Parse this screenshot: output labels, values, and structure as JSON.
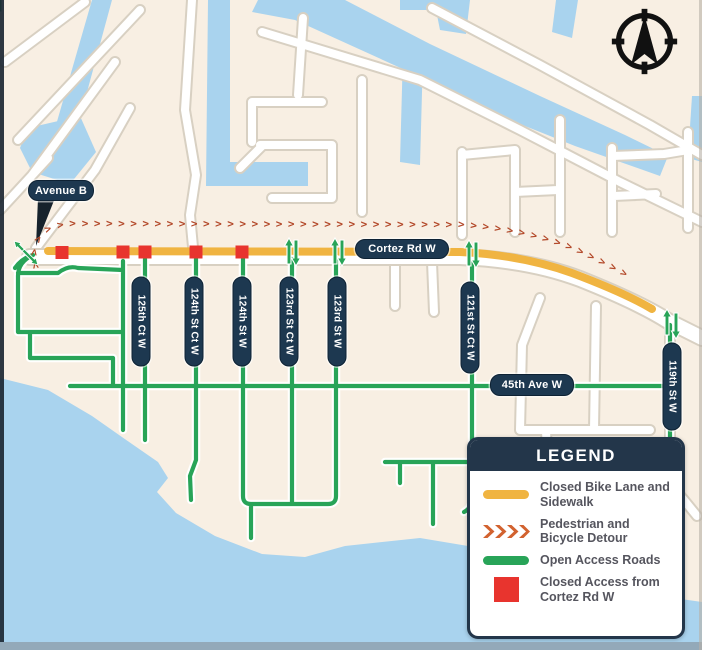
{
  "map": {
    "labels": {
      "avenue_b": "Avenue B",
      "cortez": "Cortez Rd W",
      "ave45": "45th Ave W"
    },
    "streets": [
      "125th Ct W",
      "124th St Ct W",
      "124th St W",
      "123rd St Ct W",
      "123rd St W",
      "121st St Ct W",
      "119th St W"
    ],
    "detour_glyph": ">",
    "detour_glyph_count": 52
  },
  "legend": {
    "title": "LEGEND",
    "items": [
      {
        "swatch": "closed-bike-lane-swatch",
        "label": "Closed Bike Lane and Sidewalk"
      },
      {
        "swatch": "detour-chevrons-swatch",
        "label": "Pedestrian and Bicycle Detour"
      },
      {
        "swatch": "open-access-swatch",
        "label": "Open Access Roads"
      },
      {
        "swatch": "closed-access-swatch",
        "label": "Closed Access from Cortez Rd W"
      }
    ]
  },
  "colors": {
    "land": "#f8efe3",
    "water": "#a9d3ee",
    "road_fill": "#ffffff",
    "road_casing": "#d8d0c2",
    "open_green": "#28a458",
    "closed_yellow": "#f0b441",
    "closed_red": "#e8342e",
    "detour_orange": "#b3492a",
    "label_navy": "#1d3850",
    "legend_navy": "#23364a",
    "legend_text": "#55555e",
    "sea_edge": "#93a9b9"
  }
}
